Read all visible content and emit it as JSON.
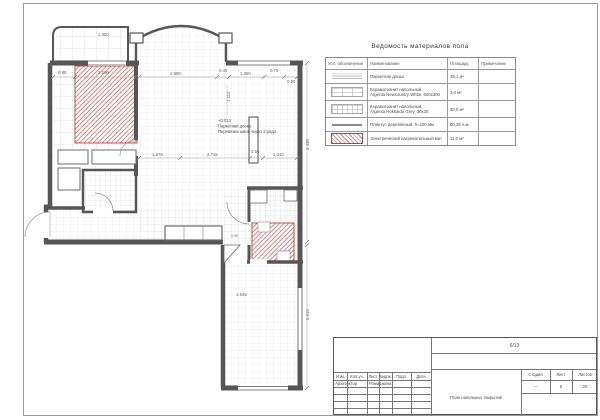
{
  "sheet": {
    "background": "#ffffff",
    "frame_color": "#9b9b9b",
    "wall_color": "#565656",
    "grid_color": "#d6d6d6",
    "mat_hatch_color": "#d2837c",
    "mat_border_color": "#b2453c"
  },
  "materials_table": {
    "title": "Ведомость материалов пола",
    "columns": {
      "symbol": "Усл. обозначение",
      "name": "Наименование",
      "area": "Площадь",
      "note": "Примечание"
    },
    "rows": [
      {
        "symbol_icon": "parquet-hatch",
        "name": "Паркетная доска",
        "area": "48,1 м²",
        "note": ""
      },
      {
        "symbol_icon": "tile-600x300",
        "name": "Керамогранит напольный,\nArgenta Newcountry White, 600х300",
        "area": "3,0 м²",
        "note": ""
      },
      {
        "symbol_icon": "tile-30x30",
        "name": "Керамогранит напольный,\nArgenta Hokkaido Grey, 30х30",
        "area": "30,0 м²",
        "note": ""
      },
      {
        "symbol_icon": "plinth-line",
        "name": "Плинтус деревянный, h=100 мм",
        "area": "80,25 п.м.",
        "note": ""
      },
      {
        "symbol_icon": "red-hatch",
        "name": "Электрический нагревательный мат",
        "area": "11,0 м²",
        "note": ""
      }
    ]
  },
  "plan": {
    "annotation": {
      "line1": "+0,014",
      "line2": "Паркетная доска",
      "line3": "Перевязка швов через 3 ряда"
    },
    "dims": [
      "2.990",
      "0.45",
      "1.350",
      "0.75",
      "0.50",
      "0.80",
      "2.260",
      "1.575",
      "2.715",
      "0.50",
      "1.310",
      "4.430",
      "5.615",
      "1.112",
      "1.545",
      "0.90",
      "1.350"
    ]
  },
  "title_block": {
    "doc_number": "6/13",
    "header_cols": [
      "Изм.",
      "Кол.уч.",
      "Лист",
      "№док.",
      "Подп.",
      "Дата"
    ],
    "role_row": {
      "role": "Архитектор",
      "name": "Ромашкина"
    },
    "sheet_title": "План напольных покрытий",
    "stage_label": "Стадия",
    "sheet_label": "Лист",
    "sheets_label": "Листов",
    "stage_value": "—",
    "sheet_value": "5",
    "sheets_value": "20"
  }
}
